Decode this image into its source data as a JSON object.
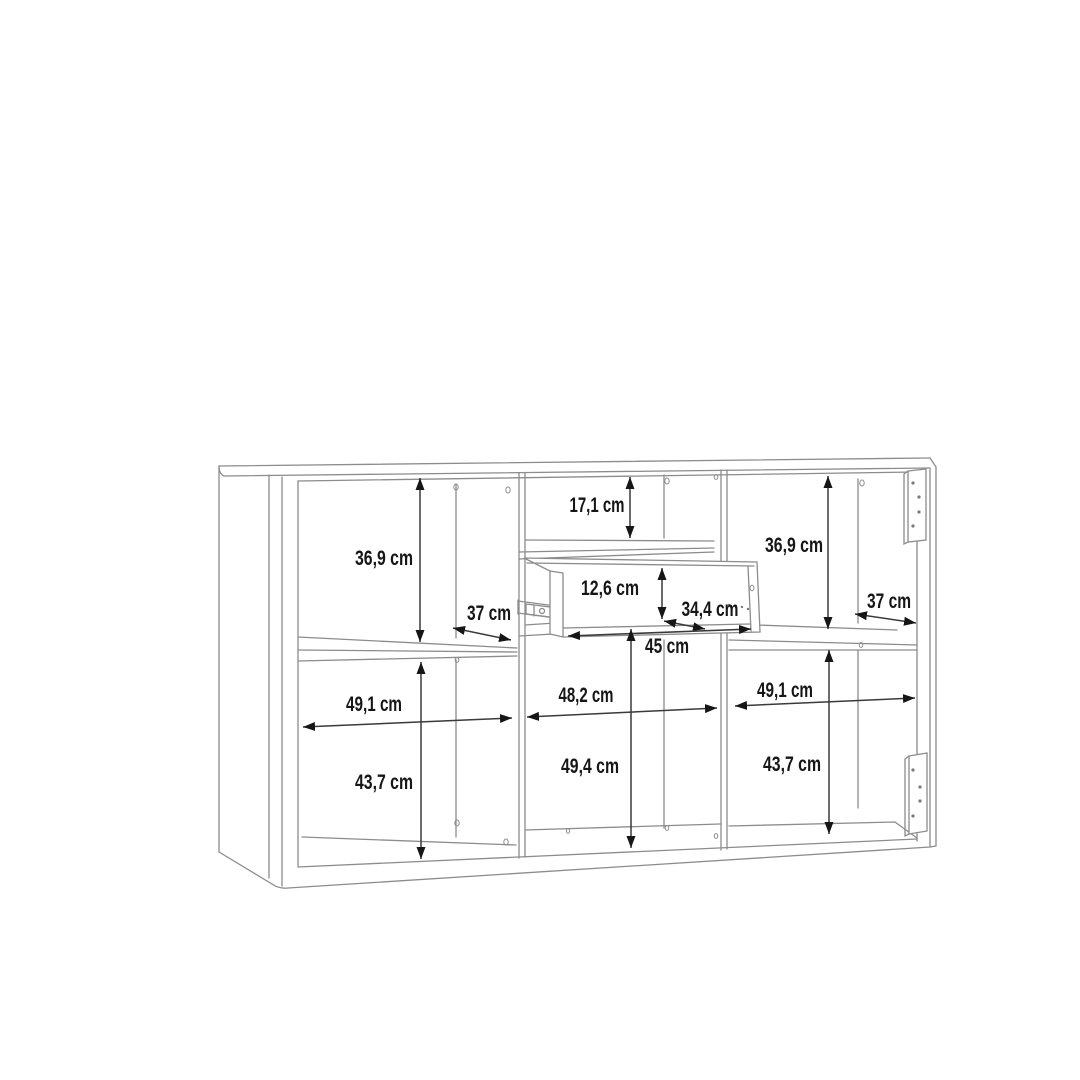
{
  "colors": {
    "background": "#ffffff",
    "cabinet_line": "#8c8c8c",
    "dimension_line": "#3a3a3a",
    "dimension_text": "#161616"
  },
  "dimensions": {
    "left_upper_height": "36,9 cm",
    "left_shelf_depth": "37 cm",
    "left_width": "49,1 cm",
    "left_lower_height": "43,7 cm",
    "middle_top_shelf_height": "17,1 cm",
    "drawer_height": "12,6 cm",
    "drawer_depth": "34,4 cm",
    "middle_lower_height": "45 cm",
    "middle_opening_height": "49,4 cm",
    "middle_width": "48,2 cm",
    "right_upper_height": "36,9 cm",
    "right_shelf_depth": "37 cm",
    "right_width": "49,1 cm",
    "right_lower_height": "43,7 cm"
  }
}
